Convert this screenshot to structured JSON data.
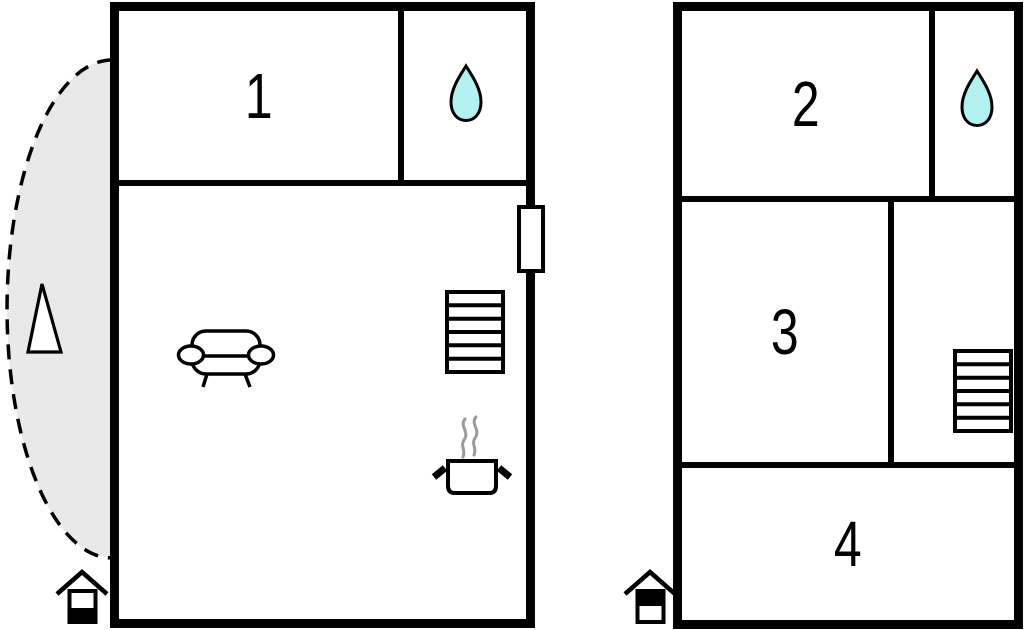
{
  "colors": {
    "wall": "#000000",
    "background": "#ffffff",
    "water_drop": "#b3f1f1",
    "terrace_fill": "#e9e9e9",
    "steam": "#9a9a9a"
  },
  "ground_floor": {
    "room1_label": "1",
    "rooms": {
      "room1": {
        "label": "1"
      },
      "bathroom": {
        "icon": "water-drop-icon"
      },
      "living_room": {
        "icons": [
          "sofa-icon",
          "stairs-icon",
          "cooking-pot-icon"
        ]
      }
    },
    "terrace": {
      "shape": "dashed-half-ellipse",
      "icon": "awning-triangle-icon"
    },
    "door": {
      "icon": "door-window"
    },
    "floor_indicator": {
      "icon": "house-ground-floor-icon",
      "filled_half": "bottom"
    }
  },
  "upper_floor": {
    "room2_label": "2",
    "room3_label": "3",
    "room4_label": "4",
    "rooms": {
      "room2": {
        "label": "2"
      },
      "bathroom": {
        "icon": "water-drop-icon"
      },
      "room3": {
        "label": "3"
      },
      "stair_room": {
        "icon": "stairs-icon"
      },
      "room4": {
        "label": "4"
      }
    },
    "floor_indicator": {
      "icon": "house-upper-floor-icon",
      "filled_half": "top"
    }
  }
}
